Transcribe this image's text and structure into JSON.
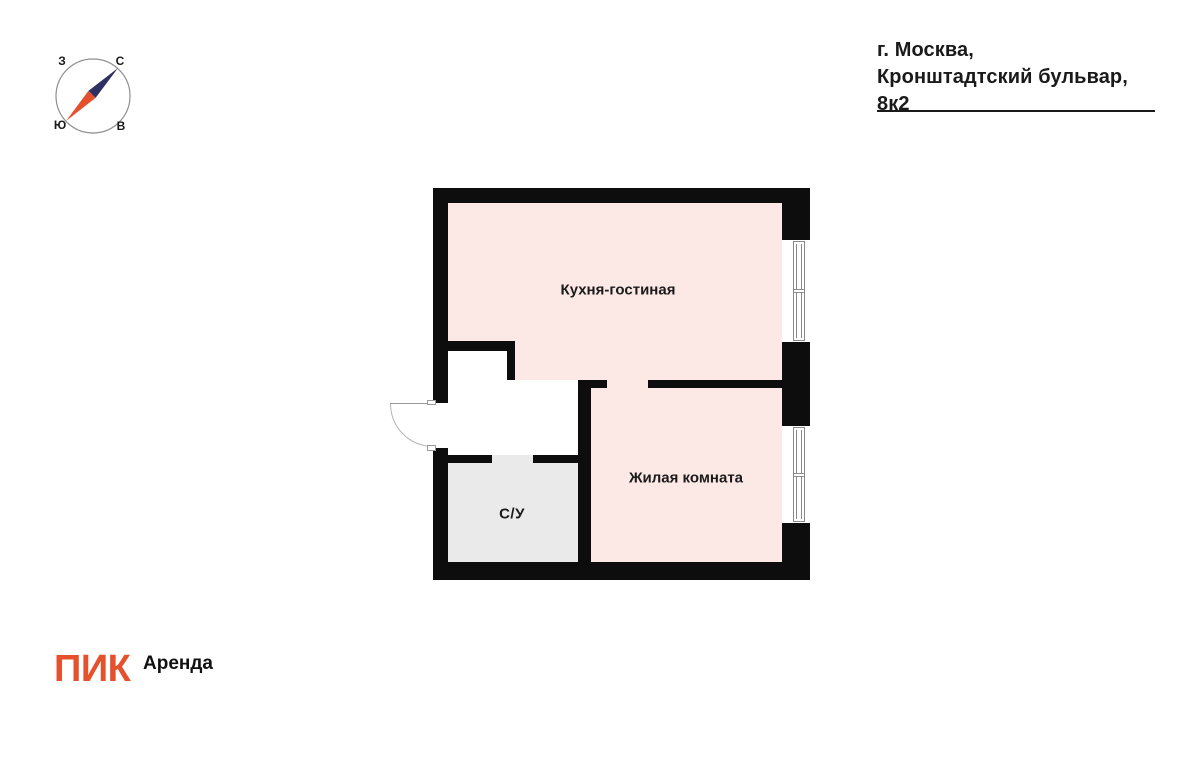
{
  "header": {
    "line1": "г. Москва,",
    "line2": "Кронштадтский бульвар, 8к2"
  },
  "compass": {
    "directions": {
      "north": "С",
      "east": "В",
      "south": "Ю",
      "west": "З"
    },
    "needle_north_color": "#303163",
    "needle_south_color": "#e4512c"
  },
  "floor_plan": {
    "rooms": [
      {
        "label": "Кухня-гостиная",
        "fill": "#fce9e5"
      },
      {
        "label": "Жилая комната",
        "fill": "#fce9e5"
      },
      {
        "label": "С/У",
        "fill": "#eaeaea"
      }
    ],
    "wall_color": "#0d0d0d",
    "windows_count": 2,
    "entrance_doors_count": 1
  },
  "logo": {
    "brand": "ПИК",
    "suffix": "Аренда",
    "brand_color": "#e4512c"
  }
}
